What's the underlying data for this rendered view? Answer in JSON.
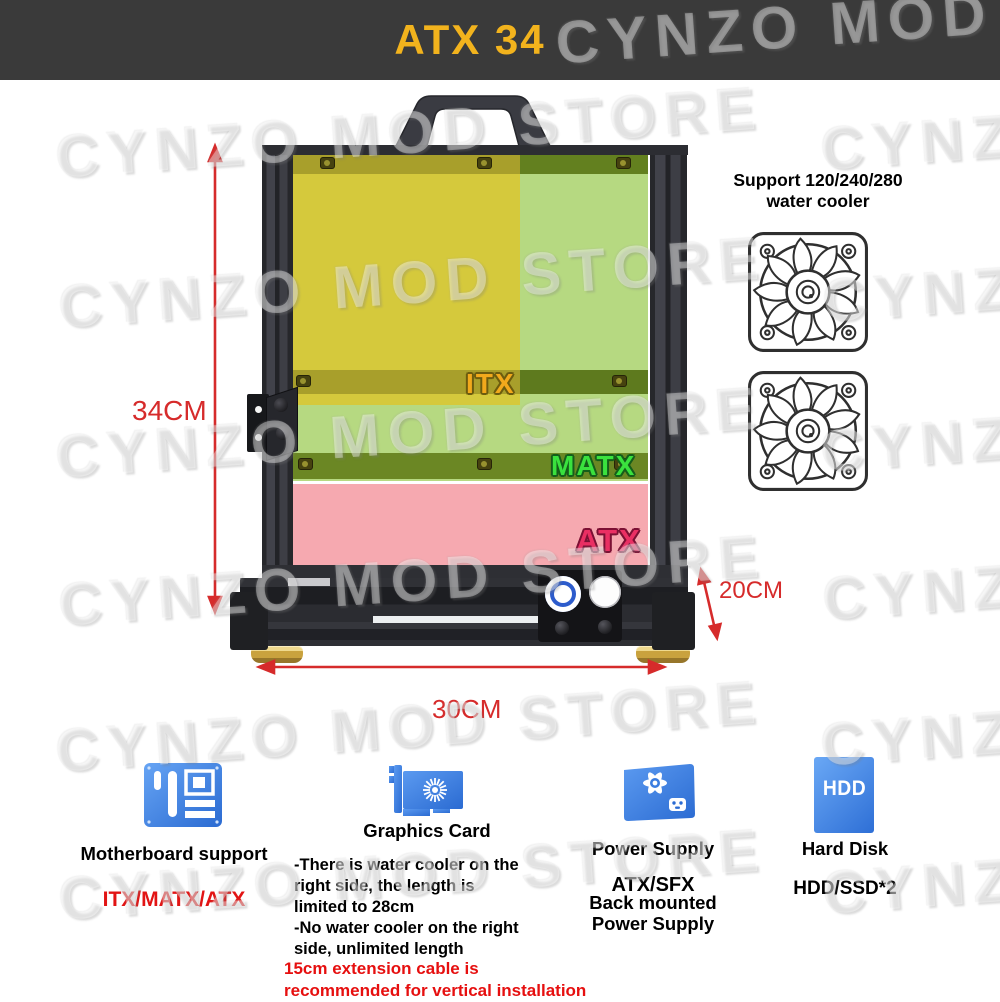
{
  "banner": {
    "title": "ATX 34"
  },
  "watermark": {
    "text": "CYNZO MOD STORE"
  },
  "zones": {
    "itx": "ITX",
    "matx": "MATX",
    "atx": "ATX"
  },
  "dims": {
    "height": "34CM",
    "width": "30CM",
    "depth": "20CM"
  },
  "cooler": {
    "lines": [
      "Support 120/240/280",
      "water cooler"
    ]
  },
  "features": {
    "motherboard": {
      "title": "Motherboard support",
      "value": "ITX/MATX/ATX"
    },
    "graphics": {
      "title": "Graphics Card",
      "notes": [
        "-There is water cooler on the",
        "right side, the length is",
        "limited to 28cm",
        "-No water cooler on the right",
        "side, unlimited length"
      ],
      "warning": [
        "15cm extension cable is",
        "recommended for vertical installation"
      ]
    },
    "power": {
      "title": "Power Supply",
      "type": "ATX/SFX",
      "mount": [
        "Back mounted",
        "Power Supply"
      ]
    },
    "storage": {
      "title": "Hard Disk",
      "value": "HDD/SSD*2",
      "badge": "HDD"
    }
  }
}
